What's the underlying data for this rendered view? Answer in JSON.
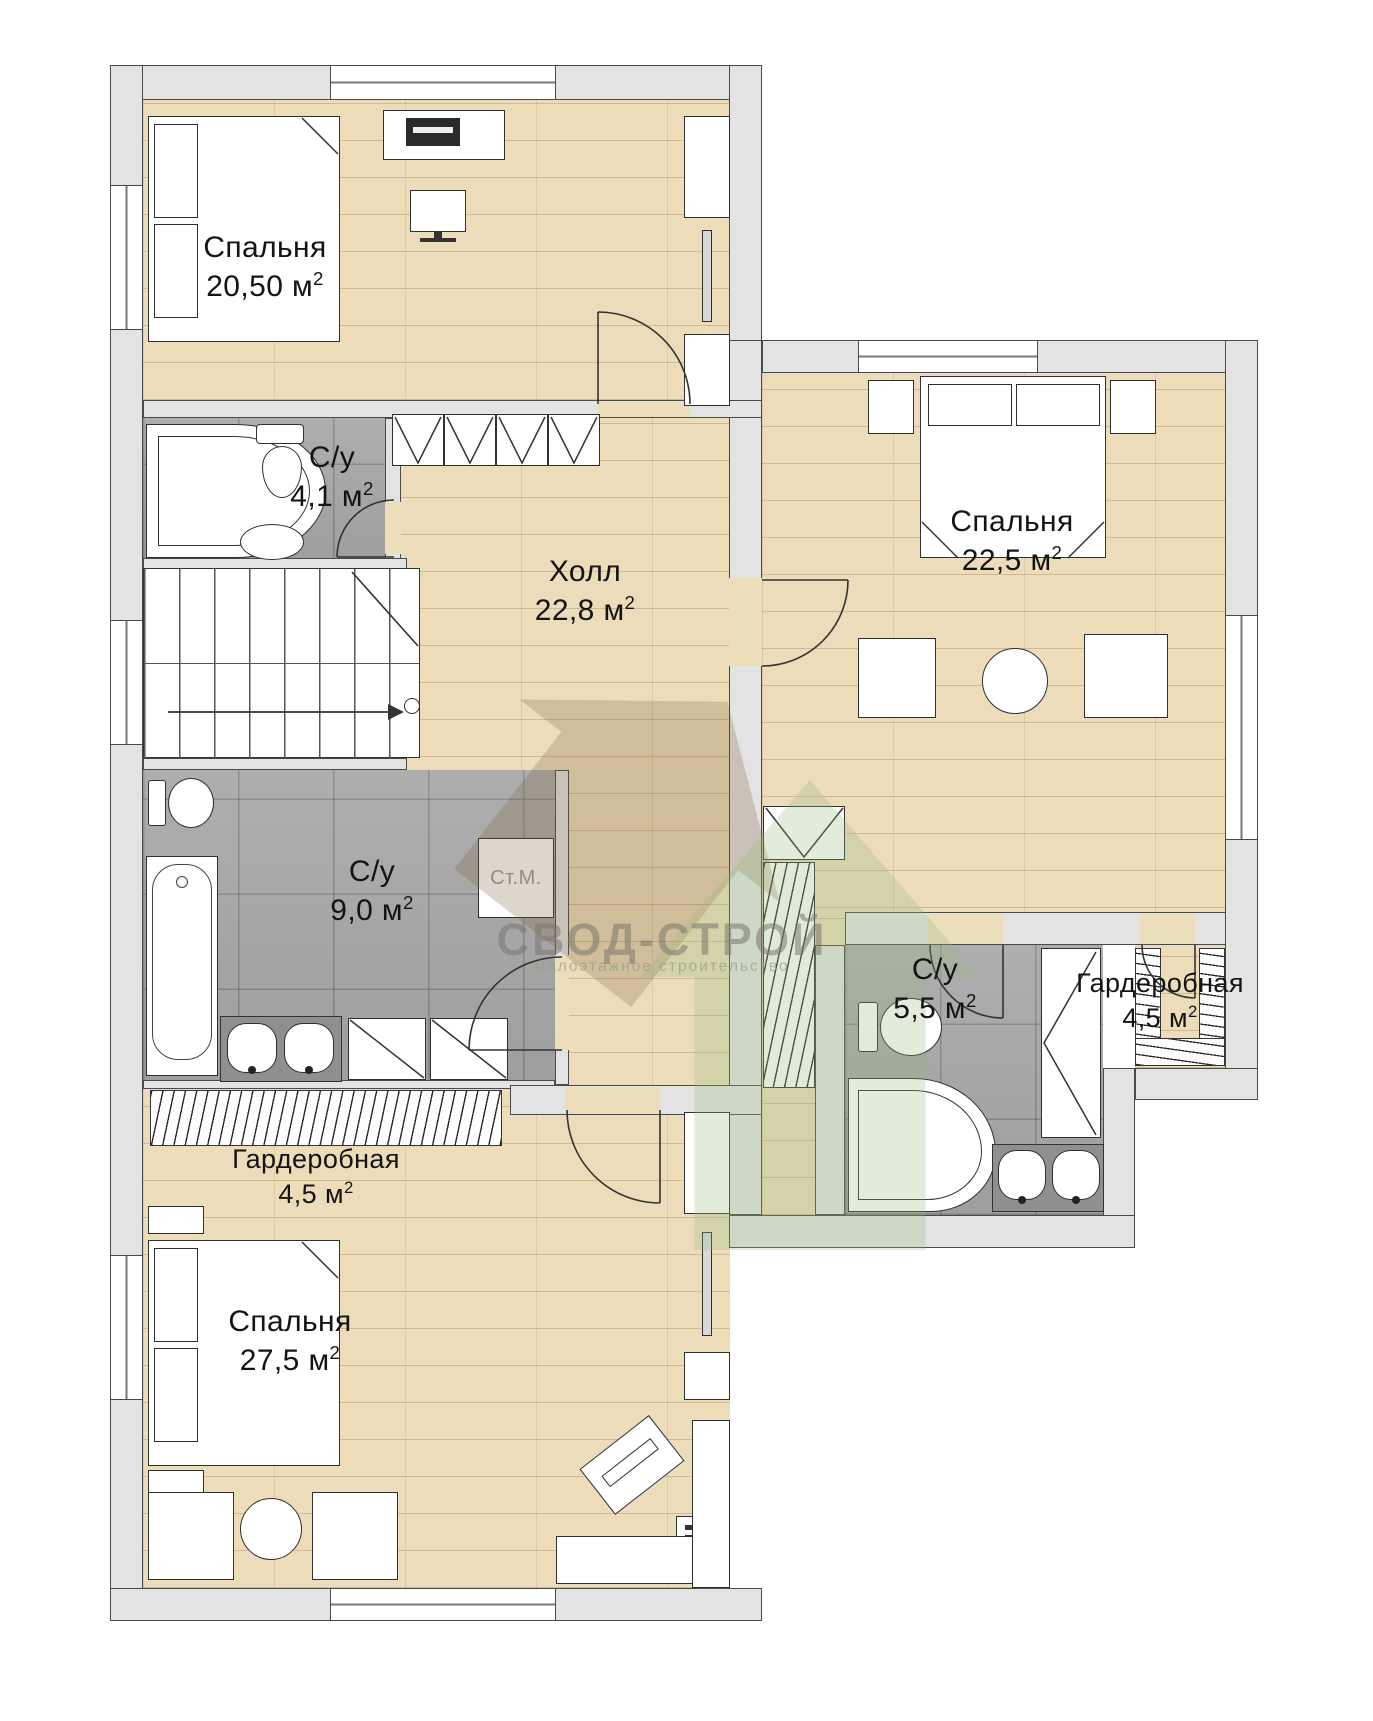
{
  "watermark": {
    "title": "СВОД-СТРОЙ",
    "subtitle": "малоэтажное строительство"
  },
  "appliance_labels": {
    "washing_machine": "Ст.М."
  },
  "rooms": {
    "bedroom_top_left": {
      "name": "Спальня",
      "area": "20,50 м",
      "sup": "2"
    },
    "bathroom_small": {
      "name": "С/у",
      "area": "4,1 м",
      "sup": "2"
    },
    "hall": {
      "name": "Холл",
      "area": "22,8 м",
      "sup": "2"
    },
    "bedroom_top_right": {
      "name": "Спальня",
      "area": "22,5 м",
      "sup": "2"
    },
    "bathroom_large": {
      "name": "С/у",
      "area": "9,0 м",
      "sup": "2"
    },
    "bathroom_right": {
      "name": "С/у",
      "area": "5,5 м",
      "sup": "2"
    },
    "wardrobe_right": {
      "name": "Гардеробная",
      "area": "4,5 м",
      "sup": "2"
    },
    "wardrobe_left": {
      "name": "Гардеробная",
      "area": "4,5 м",
      "sup": "2"
    },
    "bedroom_bottom": {
      "name": "Спальня",
      "area": "27,5 м",
      "sup": "2"
    }
  },
  "colors": {
    "wall_fill": "#e3e3e3",
    "outline": "#3a3a3a",
    "wood_floor": "#ecdcba",
    "tile_floor": "#a7a7a7",
    "watermark_green": "#96b97e",
    "watermark_brown": "#8a6a44"
  }
}
